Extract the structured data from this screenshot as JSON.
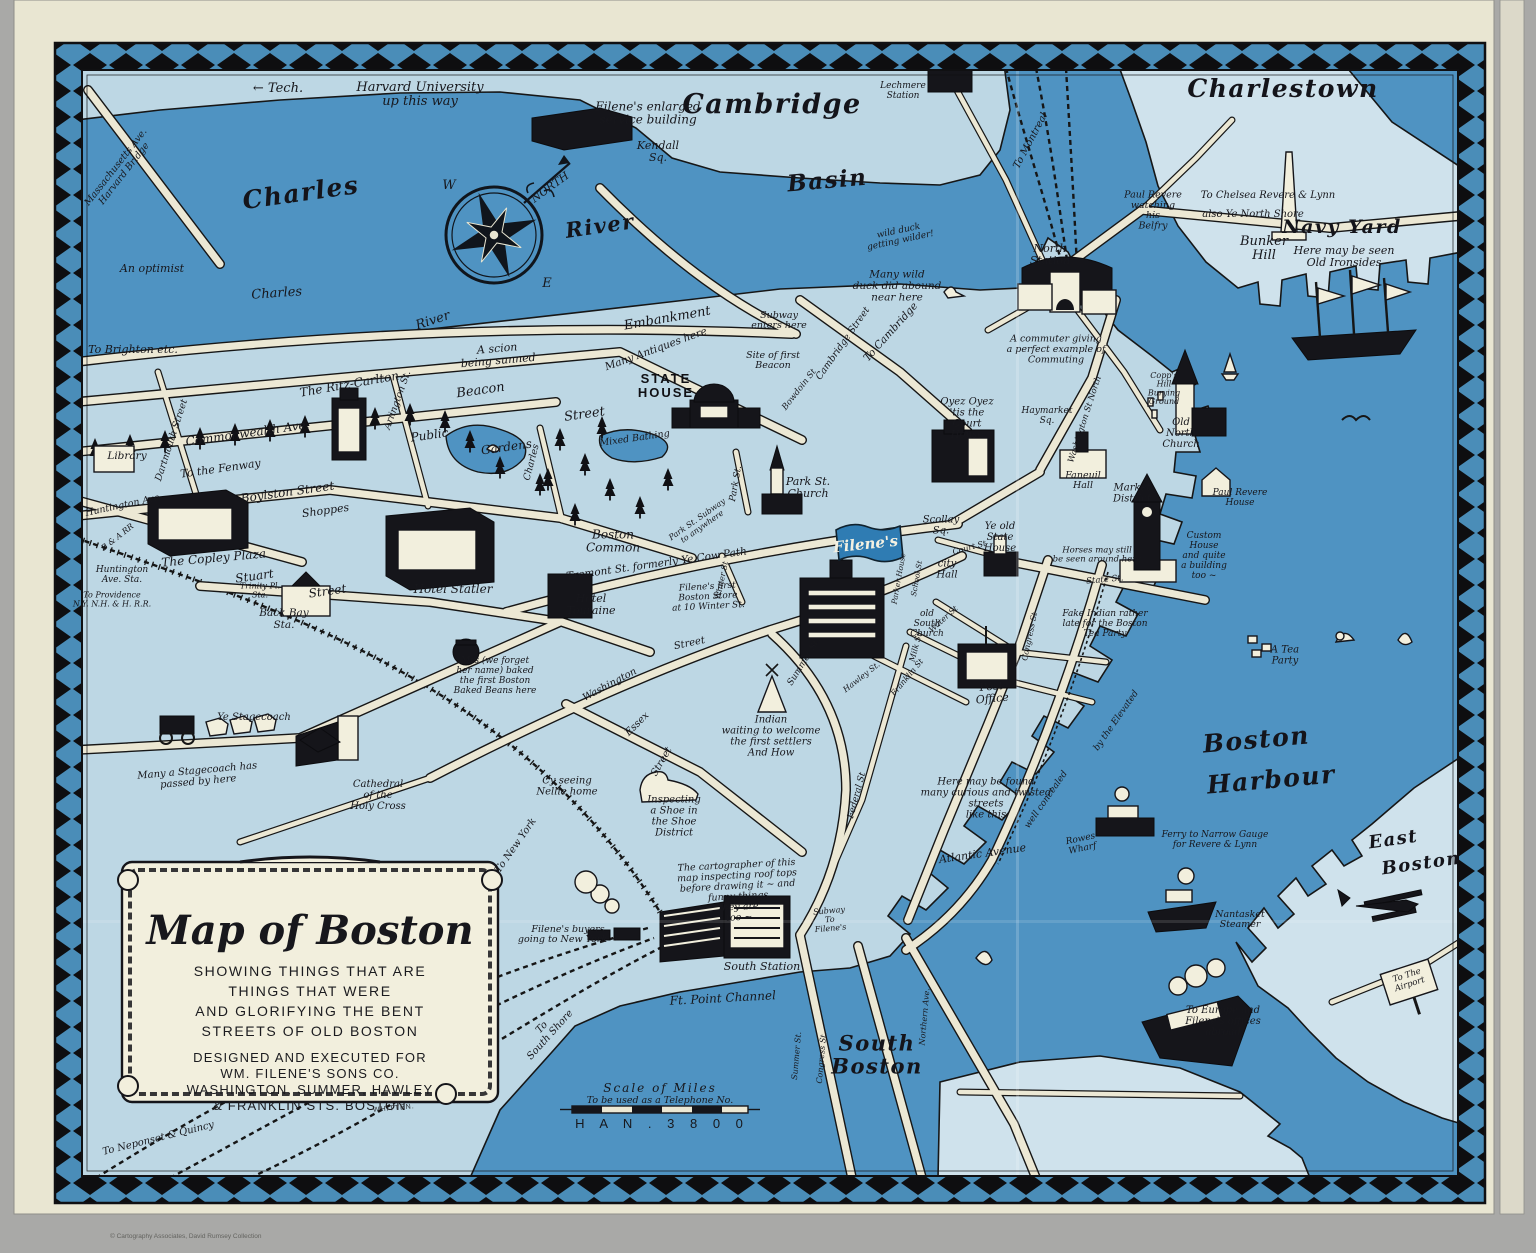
{
  "map": {
    "title": "Map of Boston",
    "cartouche": {
      "title": "Map of Boston",
      "subtitle_lines": [
        "SHOWING THINGS THAT ARE",
        "THINGS THAT WERE",
        "AND GLORIFYING THE BENT",
        "STREETS OF OLD BOSTON"
      ],
      "credit_lines": [
        "DESIGNED AND EXECUTED FOR",
        "WM. FILENE'S SONS CO.",
        "WASHINGTON, SUMMER, HAWLEY",
        "& FRANKLIN STS. BOSTON"
      ],
      "signature": "WHITTEN."
    },
    "scale": {
      "line1": "Scale   of   Miles",
      "line2": "To be used as a  Telephone  No.",
      "line3": "H A N . 3 8 0 0"
    },
    "footer": "© Cartography Associates, David Rumsey Collection",
    "colors": {
      "paper": "#e9e6d2",
      "land": "#bdd7e4",
      "land_light": "#cfe2ec",
      "water": "#4f93c2",
      "road": "#ece8d4",
      "ink": "#161616",
      "border_blue": "#4a8db8",
      "flag_blue": "#2f7cb3",
      "bg_gray": "#a9a9a7"
    },
    "labels": [
      [
        "← Tech.",
        278,
        92,
        13,
        0,
        "h"
      ],
      [
        "Harvard University\nup this way",
        420,
        98,
        13,
        0,
        "h"
      ],
      [
        "Massachusetts Ave.\nHarvard Bridge",
        122,
        172,
        9.5,
        -52,
        "h"
      ],
      [
        "Filene's enlarged\nservice building",
        648,
        117,
        12,
        0,
        "h"
      ],
      [
        "Cambridge",
        772,
        113,
        27,
        0,
        "s"
      ],
      [
        "Kendall\nSq.",
        658,
        155,
        11,
        0,
        "h"
      ],
      [
        "Lechmere\nStation",
        903,
        93,
        9,
        0,
        "h"
      ],
      [
        "To Montreal",
        1033,
        142,
        10,
        -62,
        "h"
      ],
      [
        "Charlestown",
        1283,
        97,
        25,
        0,
        "s"
      ],
      [
        "Bunker\nHill",
        1264,
        252,
        13,
        0,
        "h"
      ],
      [
        "To Chelsea  Revere & Lynn",
        1268,
        198,
        10,
        0,
        "h"
      ],
      [
        "also Ye North Shore",
        1253,
        217,
        10,
        0,
        "h"
      ],
      [
        "Navy Yard",
        1342,
        233,
        19,
        0,
        "s"
      ],
      [
        "Here may be seen\nOld Ironsides",
        1344,
        260,
        11,
        0,
        "h"
      ],
      [
        "Paul Revere\nwatching\nhis\nBelfry",
        1153,
        213,
        9.5,
        0,
        "h"
      ],
      [
        "North\nStation",
        1050,
        258,
        11,
        0,
        "h"
      ],
      [
        "A commuter giving\na perfect example of\nCommuting",
        1056,
        352,
        9.5,
        0,
        "h"
      ],
      [
        "Charles",
        302,
        201,
        25,
        -8,
        "s"
      ],
      [
        "River",
        601,
        233,
        21,
        -8,
        "s"
      ],
      [
        "Charles",
        277,
        297,
        13,
        -4,
        "h"
      ],
      [
        "River",
        434,
        324,
        13,
        -18,
        "h"
      ],
      [
        "An optimist",
        152,
        272,
        11,
        0,
        "h"
      ],
      [
        "Basin",
        828,
        188,
        23,
        -5,
        "s"
      ],
      [
        "wild duck\ngetting wilder!",
        900,
        238,
        9,
        -12,
        "h"
      ],
      [
        "Many wild\nduck did abound\nnear here",
        897,
        289,
        10.5,
        0,
        "h"
      ],
      [
        "Embankment",
        668,
        322,
        13,
        -10,
        "h"
      ],
      [
        "Many Antiques here",
        657,
        352,
        10.5,
        -20,
        "h"
      ],
      [
        "Subway\nenters here",
        779,
        323,
        9.5,
        0,
        "h"
      ],
      [
        "Cambridge Street",
        845,
        345,
        9.5,
        -55,
        "h"
      ],
      [
        "To Cambridge",
        893,
        334,
        10.5,
        -48,
        "h"
      ],
      [
        "Site of first\nBeacon",
        773,
        363,
        9.5,
        0,
        "h"
      ],
      [
        "STATE\nHOUSE",
        666,
        390,
        13,
        0,
        "c"
      ],
      [
        "Bowdoin St",
        801,
        391,
        8.5,
        -52,
        "h"
      ],
      [
        "Mixed Bathing",
        635,
        441,
        9.5,
        -8,
        "h"
      ],
      [
        "Public",
        430,
        439,
        12,
        -8,
        "h"
      ],
      [
        "Gardens",
        507,
        451,
        12,
        -8,
        "h"
      ],
      [
        "Beacon",
        481,
        394,
        13,
        -8,
        "h"
      ],
      [
        "Street",
        585,
        418,
        13,
        -8,
        "h"
      ],
      [
        "The Ritz-Carlton",
        350,
        388,
        12,
        -10,
        "h"
      ],
      [
        "To Brighton etc.",
        133,
        353,
        11,
        0,
        "h"
      ],
      [
        "Dartmouth Street",
        174,
        441,
        9.5,
        -72,
        "h"
      ],
      [
        "Commonwealth Ave.",
        248,
        437,
        12,
        -8,
        "h"
      ],
      [
        "A scion\nbeing sunned",
        498,
        358,
        11,
        -5,
        "h"
      ],
      [
        "Arlington St.",
        400,
        401,
        9.5,
        -70,
        "h"
      ],
      [
        "Charles",
        534,
        463,
        9.5,
        -75,
        "h"
      ],
      [
        "To the Fenway",
        221,
        472,
        11,
        -8,
        "h"
      ],
      [
        "Library",
        127,
        459,
        10.5,
        0,
        "h"
      ],
      [
        "Huntington Ave",
        123,
        508,
        9.5,
        -12,
        "h"
      ],
      [
        "B & A RR",
        119,
        539,
        8,
        -38,
        "h"
      ],
      [
        "Boylston Street",
        288,
        496,
        12,
        -8,
        "h"
      ],
      [
        "Shoppes",
        326,
        514,
        11,
        -8,
        "h"
      ],
      [
        "The Copley Plaza",
        214,
        562,
        12,
        -5,
        "h"
      ],
      [
        "Huntington\nAve. Sta.",
        122,
        577,
        9,
        0,
        "h"
      ],
      [
        "To Providence\nN.Y. N.H. & H. R.R.",
        112,
        602,
        8,
        0,
        "h"
      ],
      [
        "Trinity Pl.\nSta.",
        260,
        593,
        8,
        0,
        "h"
      ],
      [
        "Stuart",
        255,
        580,
        12,
        -8,
        "h"
      ],
      [
        "Street",
        328,
        595,
        12,
        -8,
        "h"
      ],
      [
        "Back Bay\nSta.",
        284,
        622,
        10.5,
        0,
        "h"
      ],
      [
        "Hotel Statler",
        453,
        593,
        12,
        0,
        "h"
      ],
      [
        "Hotel\nTouraine",
        591,
        608,
        11,
        0,
        "h"
      ],
      [
        "Tremont  St. formerly Ye Cow Path",
        657,
        567,
        10.5,
        -8,
        "h"
      ],
      [
        "Boston\nCommon",
        613,
        545,
        12,
        0,
        "h"
      ],
      [
        "Park St. Subway\nto anywhere",
        701,
        525,
        8,
        -35,
        "h"
      ],
      [
        "Park St.",
        738,
        484,
        9,
        -80,
        "h"
      ],
      [
        "Park St.\nChurch",
        808,
        491,
        11,
        0,
        "h"
      ],
      [
        "Oyez Oyez\n'tis the\nCourt\nHouse",
        967,
        421,
        10,
        0,
        "h"
      ],
      [
        "Scollay\nSq.",
        941,
        528,
        10,
        0,
        "h"
      ],
      [
        "Ye old\nState\nHouse",
        1000,
        540,
        10,
        0,
        "h"
      ],
      [
        "Court St",
        970,
        550,
        8,
        -15,
        "h"
      ],
      [
        "city\nHall",
        947,
        572,
        10,
        0,
        "h"
      ],
      [
        "Parker House",
        901,
        579,
        7.5,
        -80,
        "h"
      ],
      [
        "School St",
        919,
        579,
        7.5,
        -80,
        "h"
      ],
      [
        "old\nSouth\nChurch",
        927,
        626,
        9,
        0,
        "h"
      ],
      [
        "Water St",
        945,
        621,
        8,
        -42,
        "h"
      ],
      [
        "Milk St",
        918,
        648,
        8,
        -75,
        "h"
      ],
      [
        "Franklin St",
        909,
        679,
        8,
        -50,
        "h"
      ],
      [
        "Hawley St.",
        863,
        679,
        8,
        -38,
        "h"
      ],
      [
        "Summer St.",
        806,
        663,
        9,
        -58,
        "h"
      ],
      [
        "Congress St",
        1032,
        637,
        8,
        -78,
        "h"
      ],
      [
        "Federal St",
        859,
        796,
        9,
        -75,
        "h"
      ],
      [
        "Post\nOffice",
        992,
        696,
        11,
        -5,
        "h"
      ],
      [
        "Washington",
        611,
        687,
        10,
        -28,
        "h"
      ],
      [
        "Street",
        690,
        646,
        10,
        -12,
        "h"
      ],
      [
        "Essex",
        639,
        726,
        10,
        -45,
        "h"
      ],
      [
        "Street",
        664,
        763,
        10,
        -60,
        "h"
      ],
      [
        "Indian\nwaiting  to welcome\nthe first settlers\nAnd How",
        771,
        739,
        10,
        0,
        "h"
      ],
      [
        "Inspecting\na Shoe in\nthe Shoe\nDistrict",
        674,
        819,
        10,
        0,
        "h"
      ],
      [
        "Cy seeing\nNellie home",
        567,
        789,
        10,
        0,
        "h"
      ],
      [
        "Mrs (we forget\nher name) baked\nthe first Boston\nBaked Beans here",
        495,
        678,
        9,
        0,
        "h"
      ],
      [
        "Ye Stagecoach",
        254,
        720,
        10,
        0,
        "h"
      ],
      [
        "Many a Stagecoach has\npassed by here",
        198,
        779,
        10,
        -5,
        "h"
      ],
      [
        "Cathedral\nof the\nHoly Cross",
        378,
        798,
        10,
        0,
        "h"
      ],
      [
        "To New York",
        518,
        847,
        10,
        -55,
        "h"
      ],
      [
        "Here may be found\nmany curious and twisted\nstreets\nlike this",
        986,
        801,
        10,
        0,
        "h"
      ],
      [
        "Atlantic  Avenue",
        983,
        857,
        11,
        -8,
        "h"
      ],
      [
        "well concealed",
        1048,
        801,
        9,
        -55,
        "h"
      ],
      [
        "by the Elevated",
        1118,
        722,
        9,
        -55,
        "h"
      ],
      [
        "Rowes\nWharf",
        1082,
        846,
        9,
        -12,
        "h"
      ],
      [
        "The cartographer  of this\nmap inspecting  roof tops\nbefore drawing  it ~ and\nfunny things\nthey are\ntoo ~",
        738,
        894,
        9.5,
        -3,
        "h"
      ],
      [
        "Subway\nTo\nFilene's",
        830,
        922,
        8,
        -5,
        "h"
      ],
      [
        "South  Station",
        762,
        970,
        11,
        0,
        "h"
      ],
      [
        "Filene's buyers\ngoing to New York →",
        568,
        937,
        9.5,
        0,
        "h"
      ],
      [
        "Ft. Point  Channel",
        723,
        1002,
        12,
        -3,
        "h"
      ],
      [
        "To\nSouth Shore",
        548,
        1033,
        10,
        -48,
        "h"
      ],
      [
        "South\nBoston",
        877,
        1062,
        21,
        0,
        "s"
      ],
      [
        "Summer  St.",
        799,
        1056,
        8,
        -85,
        "h"
      ],
      [
        "Congress  St.",
        824,
        1058,
        8,
        -85,
        "h"
      ],
      [
        "Northern  Ave.",
        927,
        1017,
        8,
        -85,
        "h"
      ],
      [
        "Boston",
        1257,
        748,
        25,
        -5,
        "s"
      ],
      [
        "Harbour",
        1272,
        788,
        25,
        -5,
        "s"
      ],
      [
        "Ferry to  Narrow Gauge\nfor Revere & Lynn",
        1215,
        842,
        9,
        0,
        "h"
      ],
      [
        "Nantasket\nSteamer",
        1240,
        922,
        9.5,
        0,
        "h"
      ],
      [
        "East",
        1394,
        845,
        18,
        -8,
        "s"
      ],
      [
        "Boston",
        1422,
        869,
        18,
        -8,
        "s"
      ],
      [
        "To The\nAirport",
        1409,
        982,
        8.5,
        -18,
        "h"
      ],
      [
        "To Europe and\nFilene's offices\nabroad",
        1223,
        1024,
        10,
        0,
        "h"
      ],
      [
        "A Tea\nParty",
        1285,
        658,
        10,
        0,
        "h"
      ],
      [
        "Haymarket\nSq.",
        1047,
        418,
        9,
        0,
        "h"
      ],
      [
        "Washington  St  North",
        1087,
        420,
        8.5,
        -72,
        "h"
      ],
      [
        "Copp's\nHill\nBurying\nGround",
        1164,
        391,
        8,
        0,
        "h"
      ],
      [
        "Old\nNorth\nChurch",
        1181,
        436,
        10,
        0,
        "h"
      ],
      [
        "Faneuil\nHall",
        1083,
        483,
        9.5,
        0,
        "h"
      ],
      [
        "Market\nDistrict",
        1132,
        496,
        10,
        0,
        "h"
      ],
      [
        "Paul Revere\nHouse",
        1240,
        500,
        9,
        0,
        "h"
      ],
      [
        "Custom\nHouse\nand quite\na building\ntoo ~",
        1204,
        558,
        9,
        0,
        "h"
      ],
      [
        "Horses  may  still\nbe seen  around  here",
        1097,
        557,
        8.5,
        0,
        "h"
      ],
      [
        "State  St.",
        1105,
        582,
        8.5,
        -5,
        "h"
      ],
      [
        "Fake Indian rather\nlate for       the Boston\nTea            Party",
        1105,
        626,
        9,
        0,
        "h"
      ],
      [
        "To Neponset & Quincy",
        159,
        1141,
        10,
        -14,
        "h"
      ],
      [
        "Filene's first\nBoston Store\nat 10 Winter St.",
        708,
        599,
        9,
        -3,
        "h"
      ],
      [
        "Winter St",
        724,
        581,
        8,
        -78,
        "h"
      ],
      [
        "NORTH",
        552,
        190,
        11,
        -36,
        "h"
      ],
      [
        "W",
        449,
        189,
        13,
        0,
        "h"
      ],
      [
        "E",
        547,
        287,
        13,
        0,
        "h"
      ],
      [
        "Filene's",
        866,
        549,
        15,
        -6,
        "w"
      ]
    ]
  }
}
